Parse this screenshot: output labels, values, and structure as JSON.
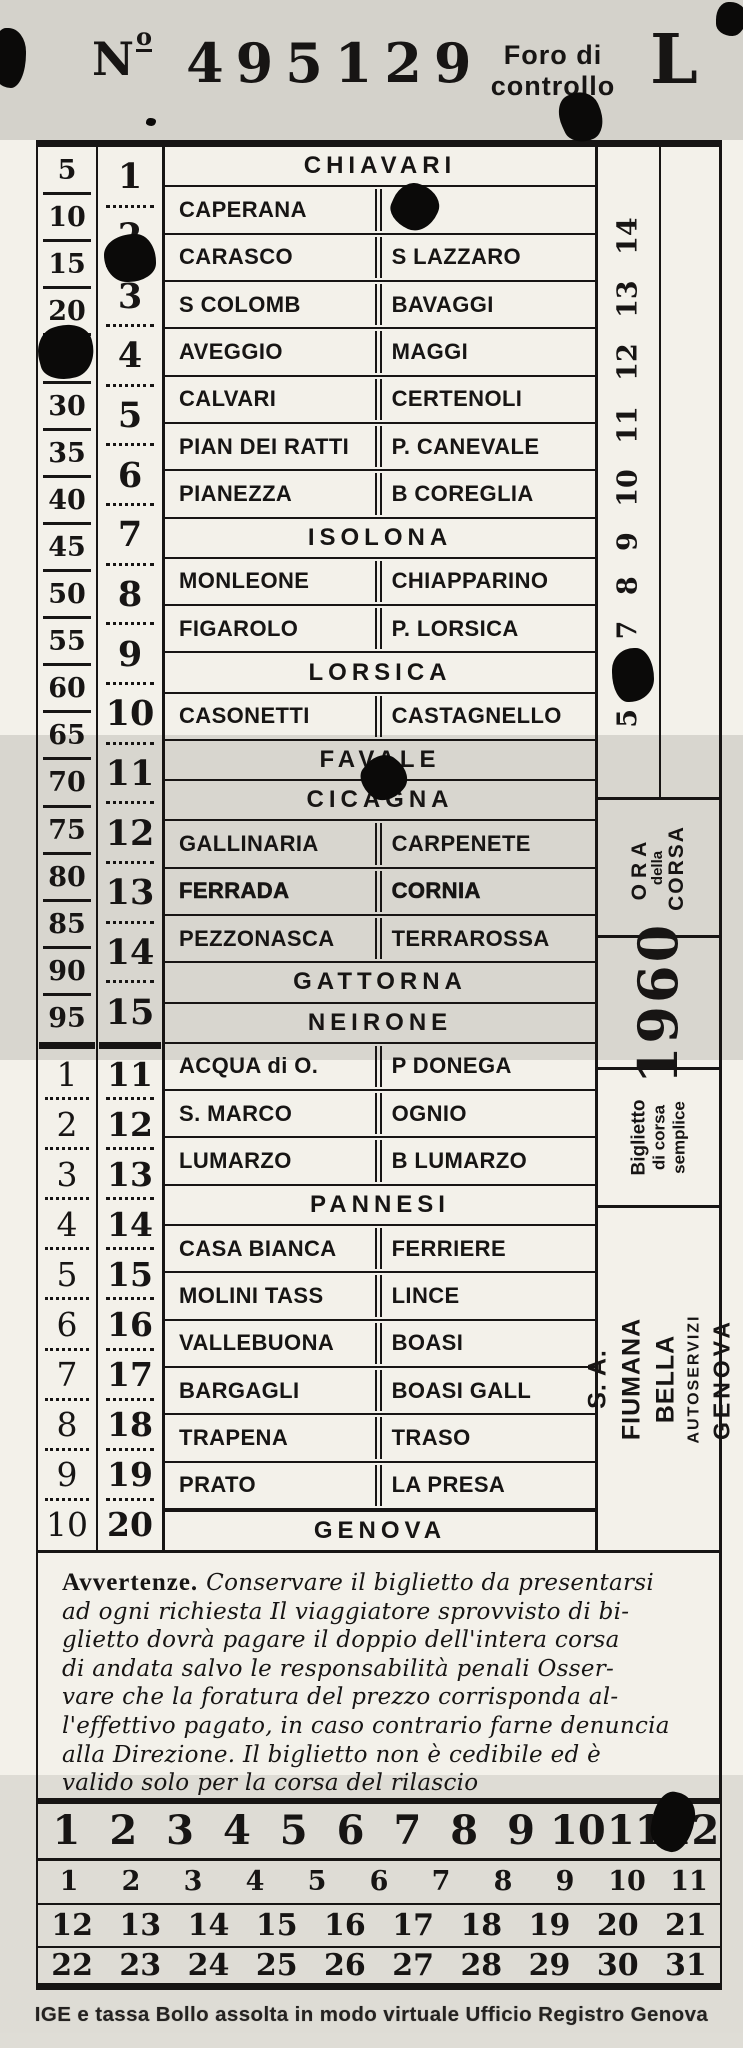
{
  "header": {
    "no_n": "N",
    "no_o": "o",
    "serial": "495129",
    "foro_line1": "Foro di",
    "foro_line2": "controllo",
    "letter": "L"
  },
  "fare_column": {
    "upper": [
      "5",
      "10",
      "15",
      "20",
      "25",
      "30",
      "35",
      "40",
      "45",
      "50",
      "55",
      "60",
      "65",
      "70",
      "75",
      "80",
      "85",
      "90",
      "95"
    ],
    "lower": [
      "1",
      "2",
      "3",
      "4",
      "5",
      "6",
      "7",
      "8",
      "9",
      "10"
    ]
  },
  "stage_column": {
    "upper": [
      "1",
      "2",
      "3",
      "4",
      "5",
      "6",
      "7",
      "8",
      "9",
      "10",
      "11",
      "12",
      "13",
      "14",
      "15"
    ],
    "lower": [
      "11",
      "12",
      "13",
      "14",
      "15",
      "16",
      "17",
      "18",
      "19",
      "20"
    ]
  },
  "stations": {
    "rows": [
      {
        "t": "h",
        "name": "CHIAVARI"
      },
      {
        "t": "p",
        "l": "CAPERANA",
        "r": "RI"
      },
      {
        "t": "p",
        "l": "CARASCO",
        "r": "S LAZZARO"
      },
      {
        "t": "p",
        "l": "S COLOMB",
        "r": "BAVAGGI"
      },
      {
        "t": "p",
        "l": "AVEGGIO",
        "r": "MAGGI"
      },
      {
        "t": "p",
        "l": "CALVARI",
        "r": "CERTENOLI"
      },
      {
        "t": "p",
        "l": "PIAN DEI RATTI",
        "r": "P. CANEVALE"
      },
      {
        "t": "p",
        "l": "PIANEZZA",
        "r": "B COREGLIA"
      },
      {
        "t": "h",
        "name": "ISOLONA"
      },
      {
        "t": "p",
        "l": "MONLEONE",
        "r": "CHIAPPARINO"
      },
      {
        "t": "p",
        "l": "FIGAROLO",
        "r": "P. LORSICA"
      },
      {
        "t": "h",
        "name": "LORSICA"
      },
      {
        "t": "p",
        "l": "CASONETTI",
        "r": "CASTAGNELLO"
      },
      {
        "t": "h",
        "name": "FAVALE"
      },
      {
        "t": "h",
        "name": "CICAGNA"
      },
      {
        "t": "p",
        "l": "GALLINARIA",
        "r": "CARPENETE"
      },
      {
        "t": "p",
        "l": "FERRADA",
        "r": "CORNIA",
        "bold": true
      },
      {
        "t": "p",
        "l": "PEZZONASCA",
        "r": "TERRAROSSA"
      },
      {
        "t": "h",
        "name": "GATTORNA"
      },
      {
        "t": "h",
        "name": "NEIRONE"
      },
      {
        "t": "p",
        "l": "ACQUA di O.",
        "r": "P DONEGA"
      },
      {
        "t": "p",
        "l": "S. MARCO",
        "r": "OGNIO"
      },
      {
        "t": "p",
        "l": "LUMARZO",
        "r": "B LUMARZO"
      },
      {
        "t": "h",
        "name": "PANNESI"
      },
      {
        "t": "p",
        "l": "CASA BIANCA",
        "r": "FERRIERE"
      },
      {
        "t": "p",
        "l": "MOLINI TASS",
        "r": "LINCE"
      },
      {
        "t": "p",
        "l": "VALLEBUONA",
        "r": "BOASI"
      },
      {
        "t": "p",
        "l": "BARGAGLI",
        "r": "BOASI GALL"
      },
      {
        "t": "p",
        "l": "TRAPENA",
        "r": "TRASO"
      },
      {
        "t": "p",
        "l": "PRATO",
        "r": "LA PRESA"
      },
      {
        "t": "h",
        "name": "GENOVA",
        "top": true
      }
    ]
  },
  "hour_strip": {
    "inner": [
      "5",
      "6",
      "7",
      "8",
      "9",
      "10",
      "11",
      "12",
      "13",
      "14"
    ],
    "outer": [
      "15",
      "16",
      "17",
      "18",
      "19",
      "20",
      "21",
      "22",
      "23",
      "24"
    ],
    "ora_line1": "ORA",
    "ora_line2": "della",
    "ora_line3": "CORSA",
    "year": "1960",
    "ticket_type_line1": "Biglietto",
    "ticket_type_line2": "di corsa",
    "ticket_type_line3": "semplice",
    "company_line1": "S. A. FIUMANA BELLA",
    "company_line2": "AUTOSERVIZI",
    "company_line3": "GENOVA"
  },
  "notice": {
    "title": "Avvertenze.",
    "first_line": "Conservare il biglietto da presentarsi",
    "lines": [
      "ad ogni richiesta  Il viaggiatore sprovvisto di bi-",
      "glietto dovrà pagare il doppio dell'intera corsa",
      "di andata salvo le responsabilità penali  Osser-",
      "vare che la foratura del prezzo corrisponda al-",
      "l'effettivo pagato, in caso contrario farne denuncia",
      "alla Direzione.   Il biglietto non è cedibile ed è",
      "valido solo per la corsa del rilascio"
    ]
  },
  "calendar": {
    "row1": [
      "1",
      "2",
      "3",
      "4",
      "5",
      "6",
      "7",
      "8",
      "9",
      "10",
      "11",
      "12"
    ],
    "row2": [
      "1",
      "2",
      "3",
      "4",
      "5",
      "6",
      "7",
      "8",
      "9",
      "10",
      "11"
    ],
    "row3": [
      "12",
      "13",
      "14",
      "15",
      "16",
      "17",
      "18",
      "19",
      "20",
      "21"
    ],
    "row4": [
      "22",
      "23",
      "24",
      "25",
      "26",
      "27",
      "28",
      "29",
      "30",
      "31"
    ]
  },
  "footer": {
    "tax_notice": "IGE e tassa Bollo assolta in modo virtuale Ufficio Registro Genova"
  }
}
